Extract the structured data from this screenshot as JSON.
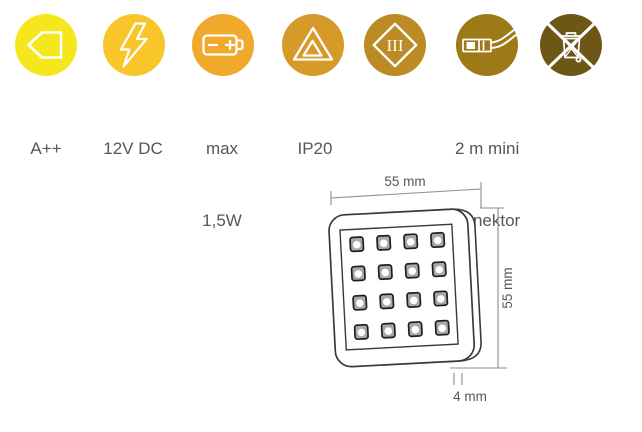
{
  "badges": [
    {
      "name": "energy-class",
      "icon": "energy-label-icon",
      "color": "#F6E71D",
      "lines": [
        "A++"
      ]
    },
    {
      "name": "voltage",
      "icon": "lightning-icon",
      "color": "#F8C52A",
      "lines": [
        "12V DC"
      ]
    },
    {
      "name": "max-power",
      "icon": "battery-icon",
      "color": "#F0A92B",
      "lines": [
        "max",
        "1,5W"
      ]
    },
    {
      "name": "ip-rating",
      "icon": "double-triangle-icon",
      "color": "#D59A28",
      "lines": [
        "IP20"
      ]
    },
    {
      "name": "protection-class",
      "icon": "class-iii-diamond-icon",
      "color": "#BD8B23",
      "symbol": "III",
      "lines": []
    },
    {
      "name": "cable",
      "icon": "mini-connector-icon",
      "color": "#9E7917",
      "lines": [
        "2 m mini",
        "konektor"
      ]
    },
    {
      "name": "weee",
      "icon": "crossed-out-bin-icon",
      "color": "#6C5716",
      "lines": []
    }
  ],
  "diagram": {
    "width_label": "55 mm",
    "height_label": "55 mm",
    "thickness_label": "4 mm",
    "led_rows": 4,
    "led_cols": 4
  }
}
